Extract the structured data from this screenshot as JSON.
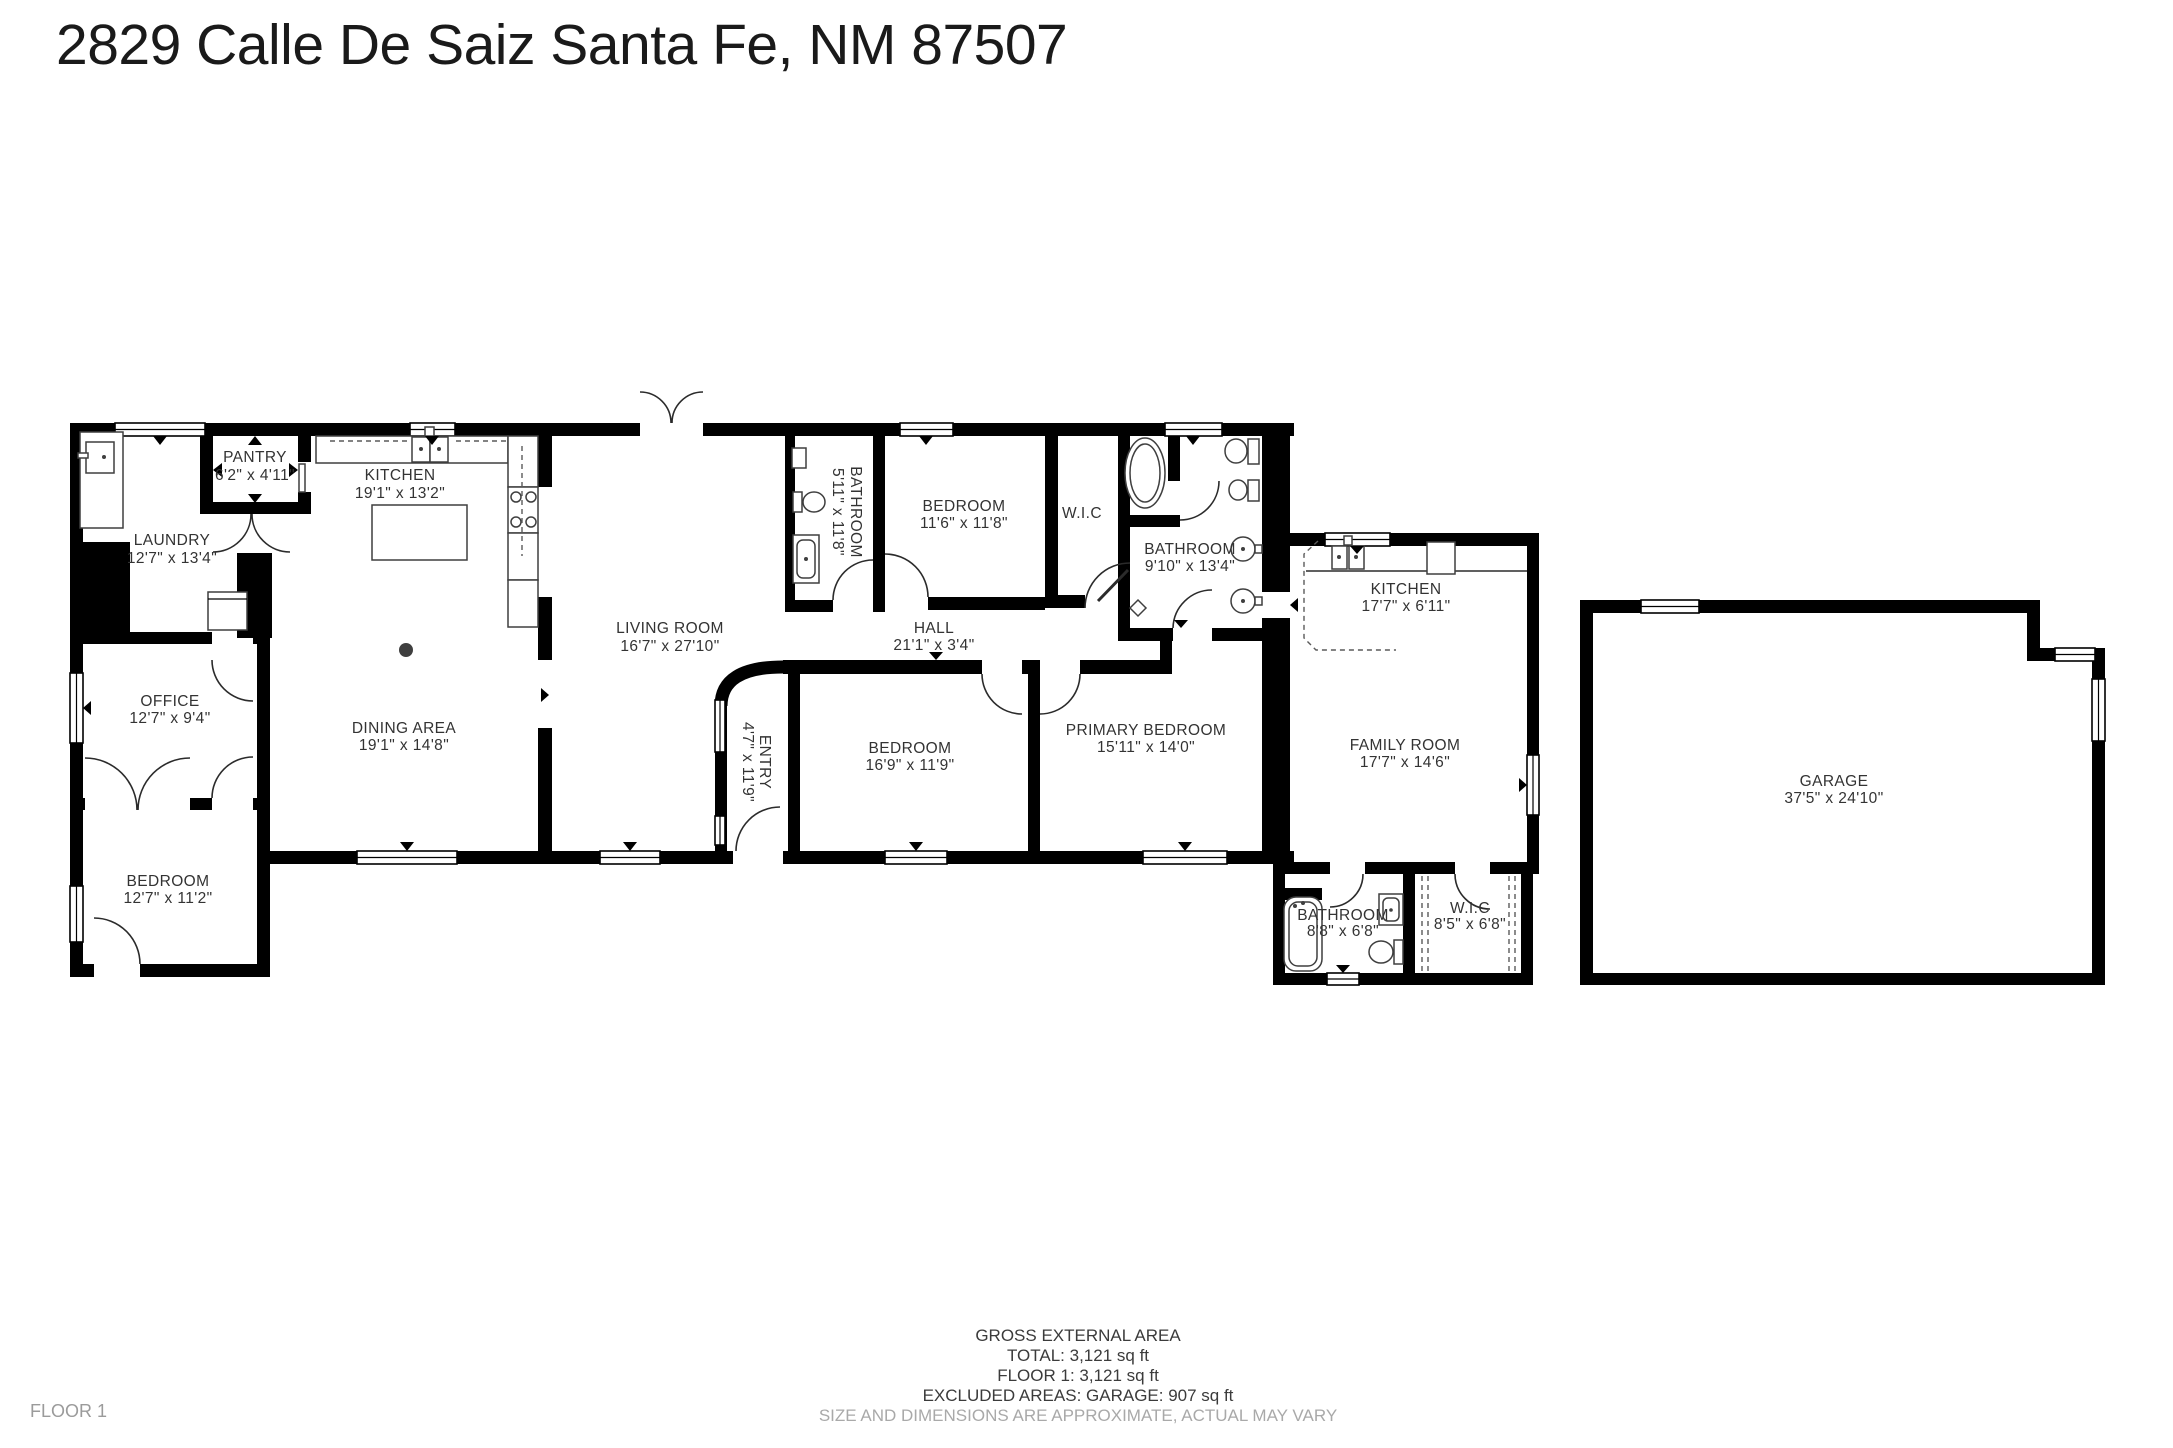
{
  "title": "2829 Calle De Saiz Santa Fe, NM 87507",
  "floor_label": "FLOOR 1",
  "rooms": {
    "pantry": {
      "name": "PANTRY",
      "dims": "6'2\" x 4'11\""
    },
    "laundry": {
      "name": "LAUNDRY",
      "dims": "12'7\" x 13'4\""
    },
    "kitchen": {
      "name": "KITCHEN",
      "dims": "19'1\" x 13'2\""
    },
    "office": {
      "name": "OFFICE",
      "dims": "12'7\" x 9'4\""
    },
    "dining": {
      "name": "DINING AREA",
      "dims": "19'1\" x 14'8\""
    },
    "bedroom_bl": {
      "name": "BEDROOM",
      "dims": "12'7\" x 11'2\""
    },
    "living": {
      "name": "LIVING ROOM",
      "dims": "16'7\" x 27'10\""
    },
    "bathroom_small": {
      "name": "BATHROOM",
      "dims": "5'11\" x 11'8\""
    },
    "bedroom_top": {
      "name": "BEDROOM",
      "dims": "11'6\" x 11'8\""
    },
    "wic_top": {
      "name": "W.I.C"
    },
    "bathroom_primary": {
      "name": "BATHROOM",
      "dims": "9'10\" x 13'4\""
    },
    "hall": {
      "name": "HALL",
      "dims": "21'1\" x 3'4\""
    },
    "entry": {
      "name": "ENTRY",
      "dims": "4'7\" x 11'9\""
    },
    "bedroom_mid": {
      "name": "BEDROOM",
      "dims": "16'9\" x 11'9\""
    },
    "primary_bedroom": {
      "name": "PRIMARY BEDROOM",
      "dims": "15'11\" x 14'0\""
    },
    "kitchen_right": {
      "name": "KITCHEN",
      "dims": "17'7\" x 6'11\""
    },
    "family": {
      "name": "FAMILY ROOM",
      "dims": "17'7\" x 14'6\""
    },
    "bathroom_annex": {
      "name": "BATHROOM",
      "dims": "8'8\" x 6'8\""
    },
    "wic_annex": {
      "name": "W.I.C",
      "dims": "8'5\" x 6'8\""
    },
    "garage": {
      "name": "GARAGE",
      "dims": "37'5\" x 24'10\""
    }
  },
  "footer": {
    "line1": "GROSS EXTERNAL AREA",
    "line2": "TOTAL: 3,121 sq ft",
    "line3": "FLOOR 1: 3,121 sq ft",
    "line4": "EXCLUDED AREAS: GARAGE: 907 sq ft",
    "disclaimer": "SIZE AND DIMENSIONS ARE APPROXIMATE, ACTUAL MAY VARY"
  },
  "colors": {
    "wall": "#000000",
    "label": "#333333",
    "muted": "#a9a9a9"
  }
}
